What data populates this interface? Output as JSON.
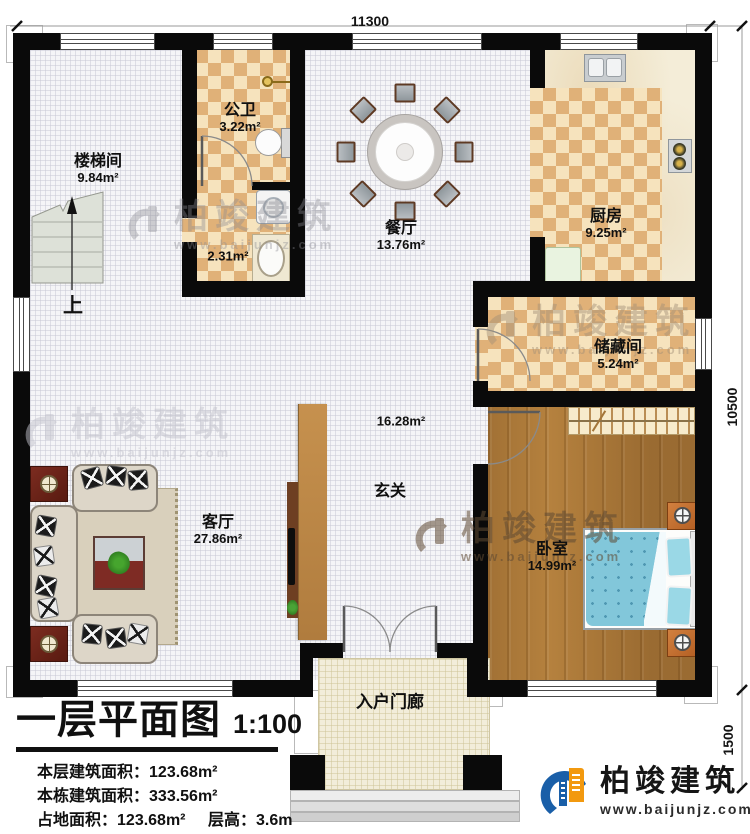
{
  "dimensions": {
    "top": "11300",
    "right": "10500",
    "porch": "1500"
  },
  "rooms": [
    {
      "name": "楼梯间",
      "area": "9.84m²"
    },
    {
      "name": "公卫",
      "area": "3.22m²"
    },
    {
      "name": "",
      "area": "2.31m²"
    },
    {
      "name": "餐厅",
      "area": "13.76m²"
    },
    {
      "name": "厨房",
      "area": "9.25m²"
    },
    {
      "name": "储藏间",
      "area": "5.24m²"
    },
    {
      "name": "玄关",
      "area": "16.28m²"
    },
    {
      "name": "客厅",
      "area": "27.86m²"
    },
    {
      "name": "卧室",
      "area": "14.99m²"
    },
    {
      "name": "入户门廊",
      "area": ""
    }
  ],
  "stairs": {
    "up_label": "上"
  },
  "title_block": {
    "title": "一层平面图",
    "scale": "1:100",
    "rows": [
      {
        "label": "本层建筑面积：",
        "value": "123.68m²"
      },
      {
        "label": "本栋建筑面积：",
        "value": "333.56m²"
      },
      {
        "label": "占地面积：",
        "value": "123.68m²",
        "label2": "层高：",
        "value2": "3.6m"
      }
    ]
  },
  "branding": {
    "company": "柏竣建筑",
    "website": "www.baijunjz.com"
  },
  "colors": {
    "wall": "#0a0a0a",
    "tile_dark": "#e0b178",
    "tile_light": "#f6e3bd",
    "wood_floor": "#b5813e",
    "bed": "#82c7da",
    "porch_floor": "#f2edda",
    "logo_blue": "#1a5fa8",
    "logo_orange": "#f2990f"
  }
}
